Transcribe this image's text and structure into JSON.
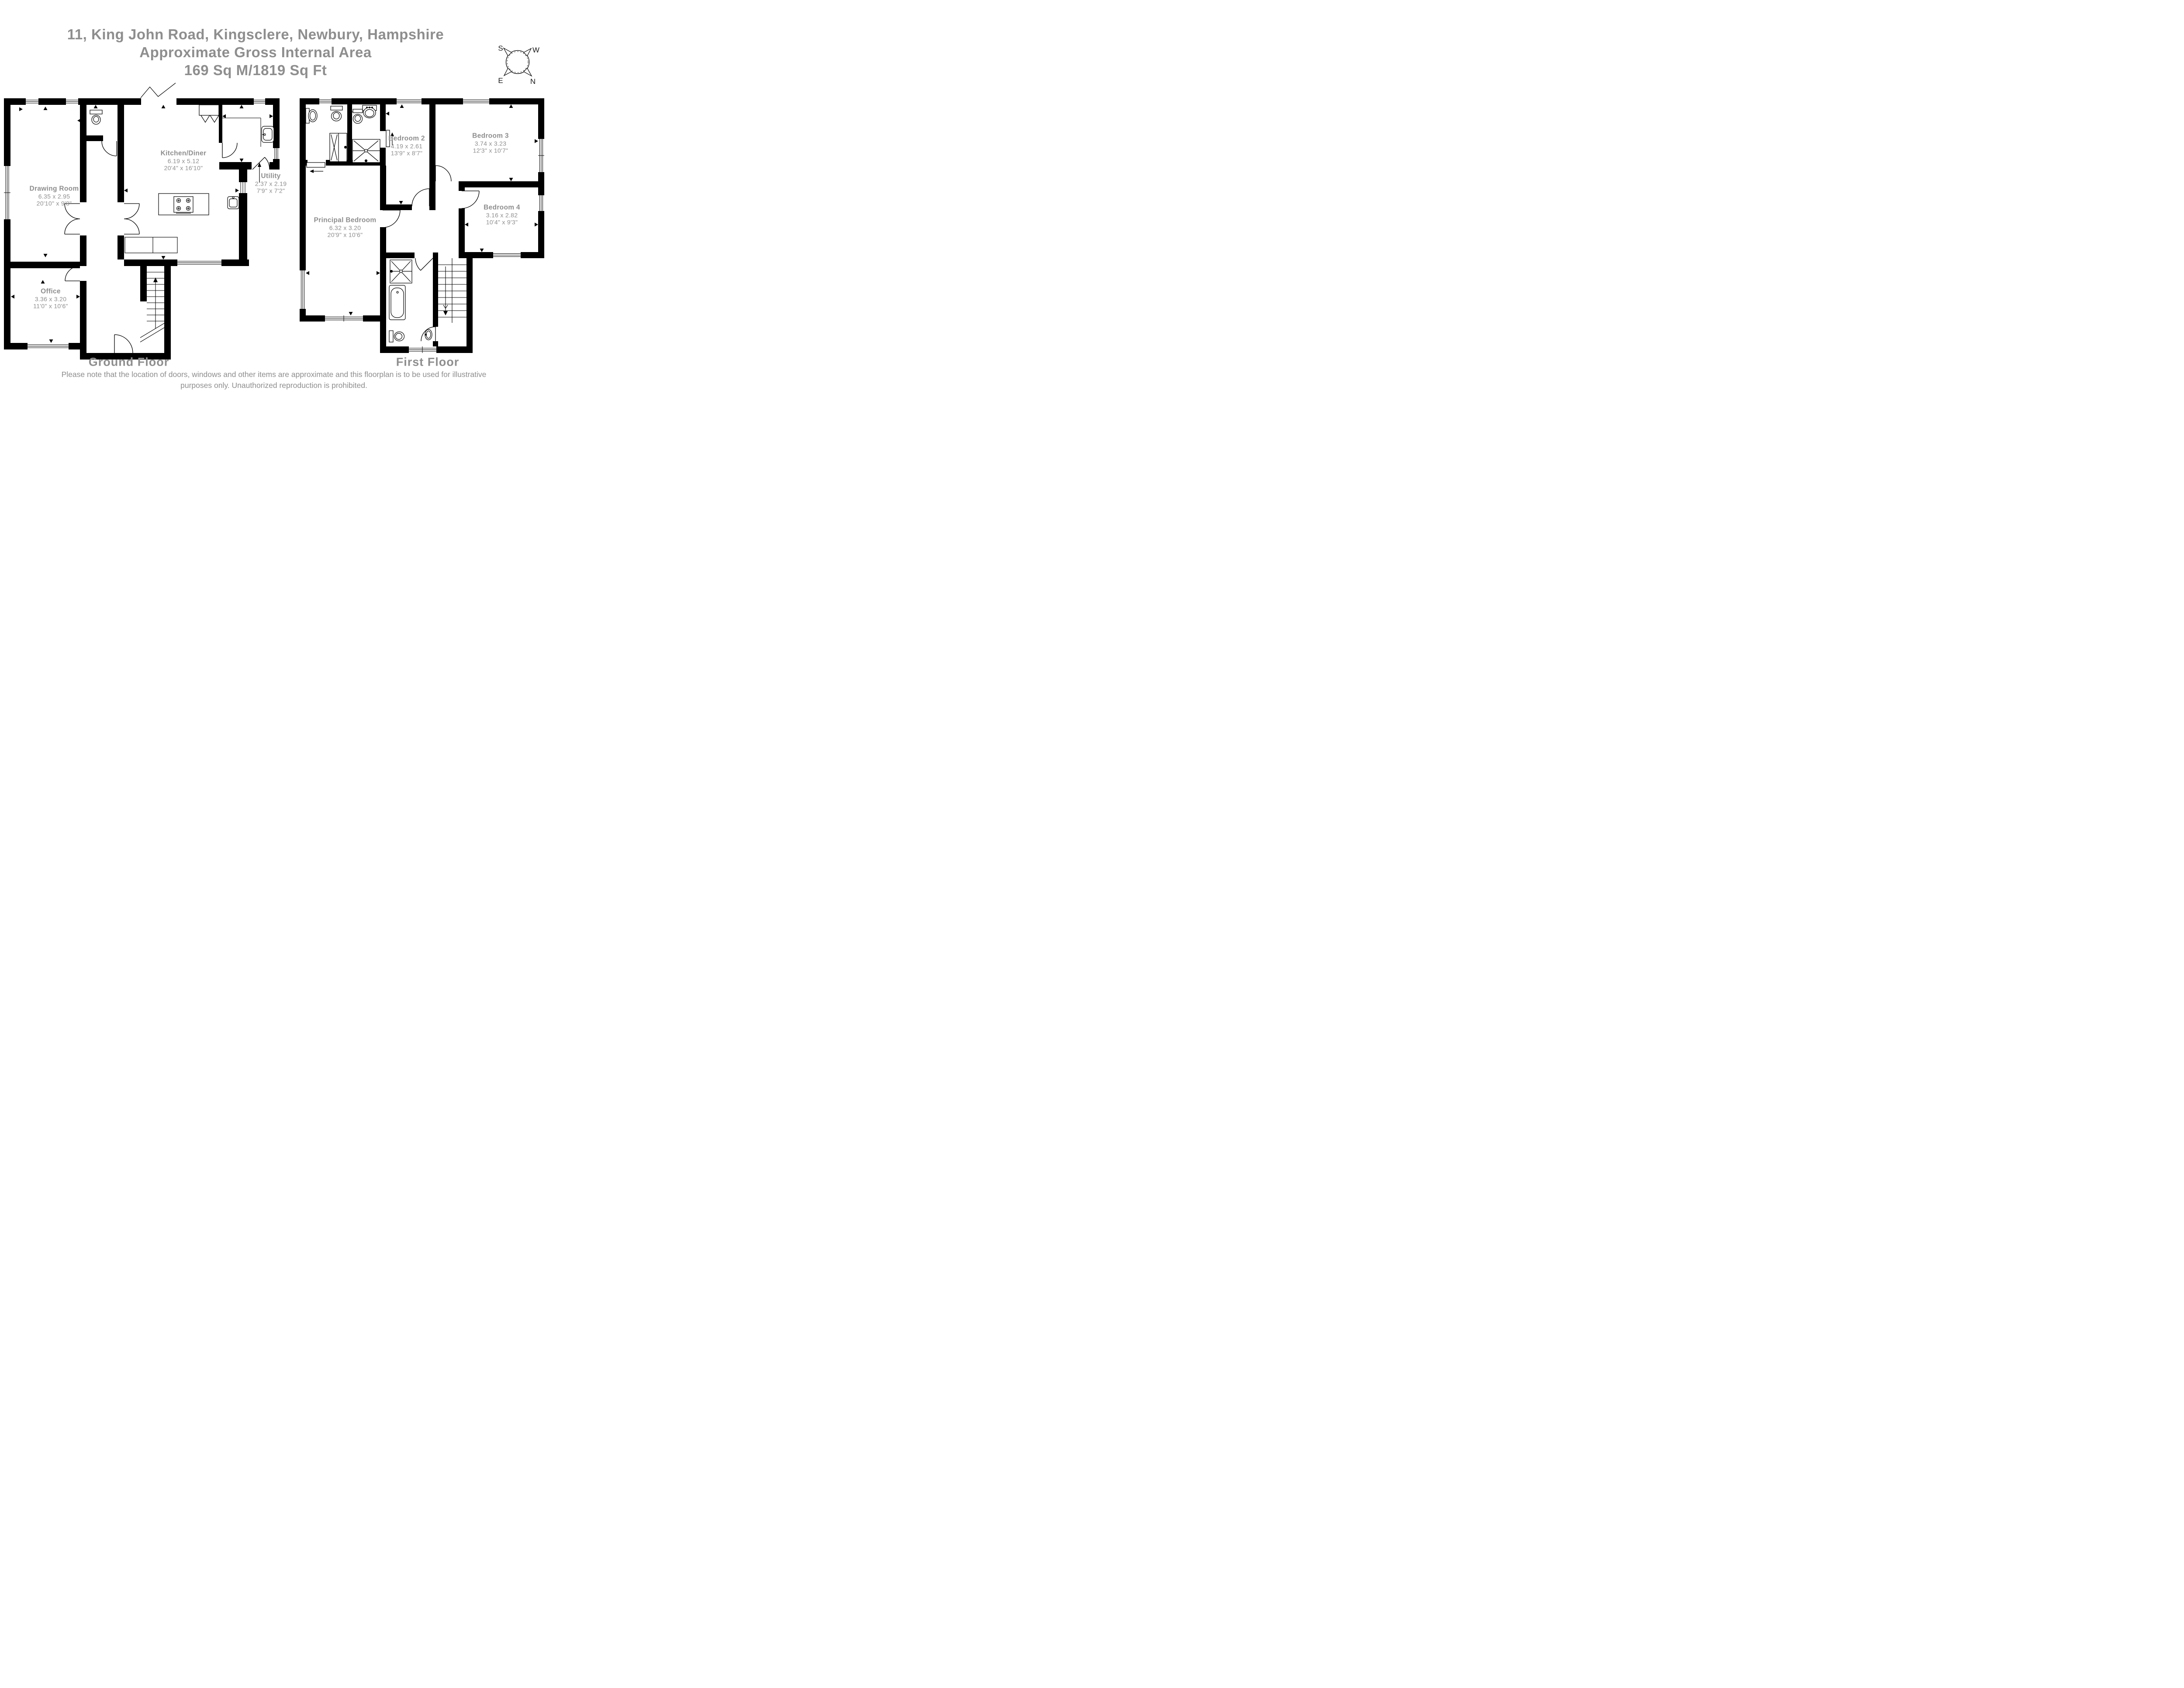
{
  "title": {
    "address": "11, King John Road, Kingsclere, Newbury, Hampshire",
    "subtitle": "Approximate Gross Internal Area",
    "area": "169 Sq M/1819 Sq Ft"
  },
  "compass": {
    "south": "S",
    "west": "W",
    "east": "E",
    "north": "N"
  },
  "ground_floor": {
    "label": "Ground Floor",
    "rooms": {
      "drawing_room": {
        "name": "Drawing Room",
        "metric": "6.35 x 2.95",
        "imperial": "20'10\" x 9'8\""
      },
      "office": {
        "name": "Office",
        "metric": "3.36 x 3.20",
        "imperial": "11'0\" x 10'6\""
      },
      "kitchen_diner": {
        "name": "Kitchen/Diner",
        "metric": "6.19 x 5.12",
        "imperial": "20'4\" x 16'10\""
      },
      "utility": {
        "name": "Utility",
        "metric": "2.37 x 2.19",
        "imperial": "7'9\" x 7'2\""
      }
    }
  },
  "first_floor": {
    "label": "First Floor",
    "rooms": {
      "principal_bedroom": {
        "name": "Principal Bedroom",
        "metric": "6.32 x 3.20",
        "imperial": "20'9\" x 10'6\""
      },
      "bedroom_2": {
        "name": "Bedroom 2",
        "metric": "4.19 x 2.61",
        "imperial": "13'9\" x 8'7\""
      },
      "bedroom_3": {
        "name": "Bedroom 3",
        "metric": "3.74 x 3.23",
        "imperial": "12'3\" x 10'7\""
      },
      "bedroom_4": {
        "name": "Bedroom 4",
        "metric": "3.16 x 2.82",
        "imperial": "10'4\" x 9'3\""
      }
    }
  },
  "disclaimer": {
    "line1": "Please note that the location of doors, windows and other items are approximate and this floorplan is to be used for illustrative",
    "line2": "purposes only. Unauthorized reproduction is prohibited."
  },
  "colors": {
    "walls": "#000000",
    "labels": "#8e8e8e",
    "background": "#ffffff"
  }
}
